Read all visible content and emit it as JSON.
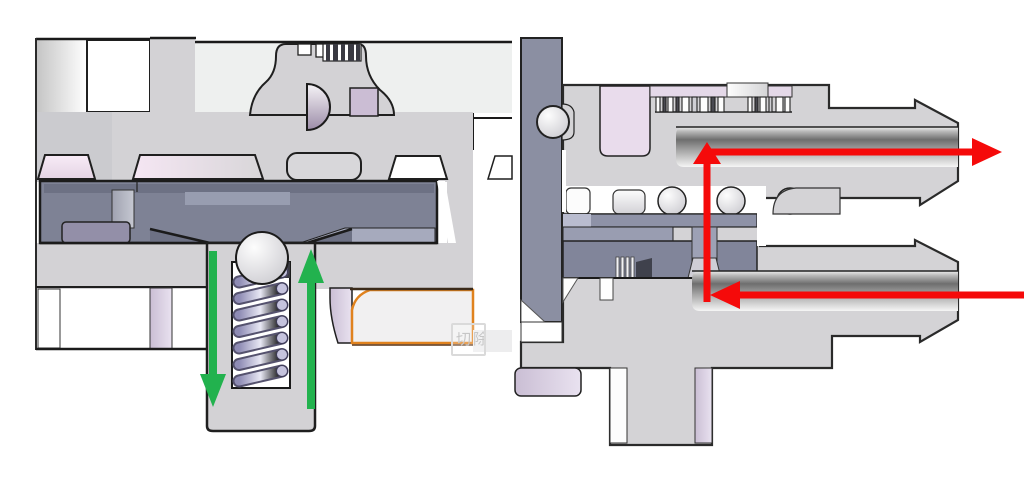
{
  "watermark": {
    "label": "切除"
  },
  "colors": {
    "green_arrow": "#22b24e",
    "red_arrow": "#f50a0a",
    "orange_outline": "#e0821e",
    "body_gray": "#d3d2d5",
    "panel_light": "#eef0ef",
    "slate_chamber": "#7e8295",
    "slate_plate": "#8b8fa2",
    "pink_seal": "#f2e4f1",
    "lavender": "#cfc4d8",
    "bore_dark": "#6e6e6e",
    "spring_steel": "#a3a0c6"
  }
}
